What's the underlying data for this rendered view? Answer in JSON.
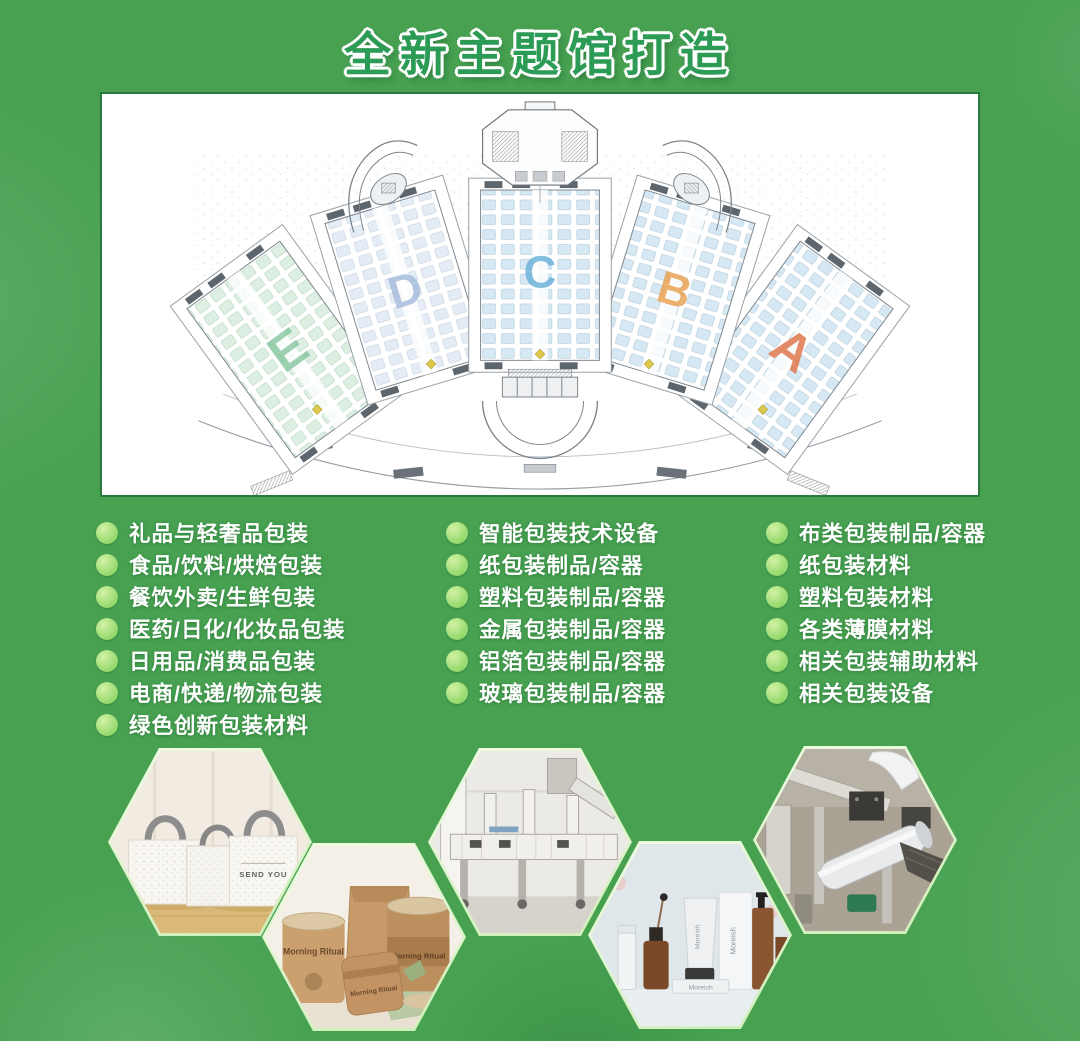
{
  "title": {
    "text": "全新主题馆打造",
    "fill_color": "#2c9b55",
    "outline_color": "#ffffff"
  },
  "floor_plan": {
    "name": "展馆平面图",
    "halls": [
      {
        "label": "E",
        "color": "#8cc9a4"
      },
      {
        "label": "D",
        "color": "#a7bedd"
      },
      {
        "label": "C",
        "color": "#6fb3da"
      },
      {
        "label": "B",
        "color": "#e9a455"
      },
      {
        "label": "A",
        "color": "#e0784e"
      }
    ]
  },
  "categories": {
    "column1": [
      "礼品与轻奢品包装",
      "食品/饮料/烘焙包装",
      "餐饮外卖/生鲜包装",
      "医药/日化/化妆品包装",
      "日用品/消费品包装",
      "电商/快递/物流包装",
      "绿色创新包装材料"
    ],
    "column2": [
      "智能包装技术设备",
      "纸包装制品/容器",
      "塑料包装制品/容器",
      "金属包装制品/容器",
      "铝箔包装制品/容器",
      "玻璃包装制品/容器"
    ],
    "column3": [
      "布类包装制品/容器",
      "纸包装材料",
      "塑料包装材料",
      "各类薄膜材料",
      "相关包装辅助材料",
      "相关包装设备"
    ]
  },
  "bullet": {
    "color": "#93d86c"
  },
  "photos": [
    {
      "name": "tote-bags",
      "depicts": "white non-woven gift tote bags with grey handles",
      "caption": "SEND YOU"
    },
    {
      "name": "kraft-jars",
      "depicts": "kraft paper jars and pouches",
      "caption": "Morning Ritual"
    },
    {
      "name": "packaging-machine",
      "depicts": "white packaging production machine",
      "caption": ""
    },
    {
      "name": "cosmetics",
      "depicts": "skincare bottles and tubes on light blue background",
      "caption": "Moreish"
    },
    {
      "name": "film-machine",
      "depicts": "film roll wrapping machine",
      "caption": ""
    }
  ]
}
